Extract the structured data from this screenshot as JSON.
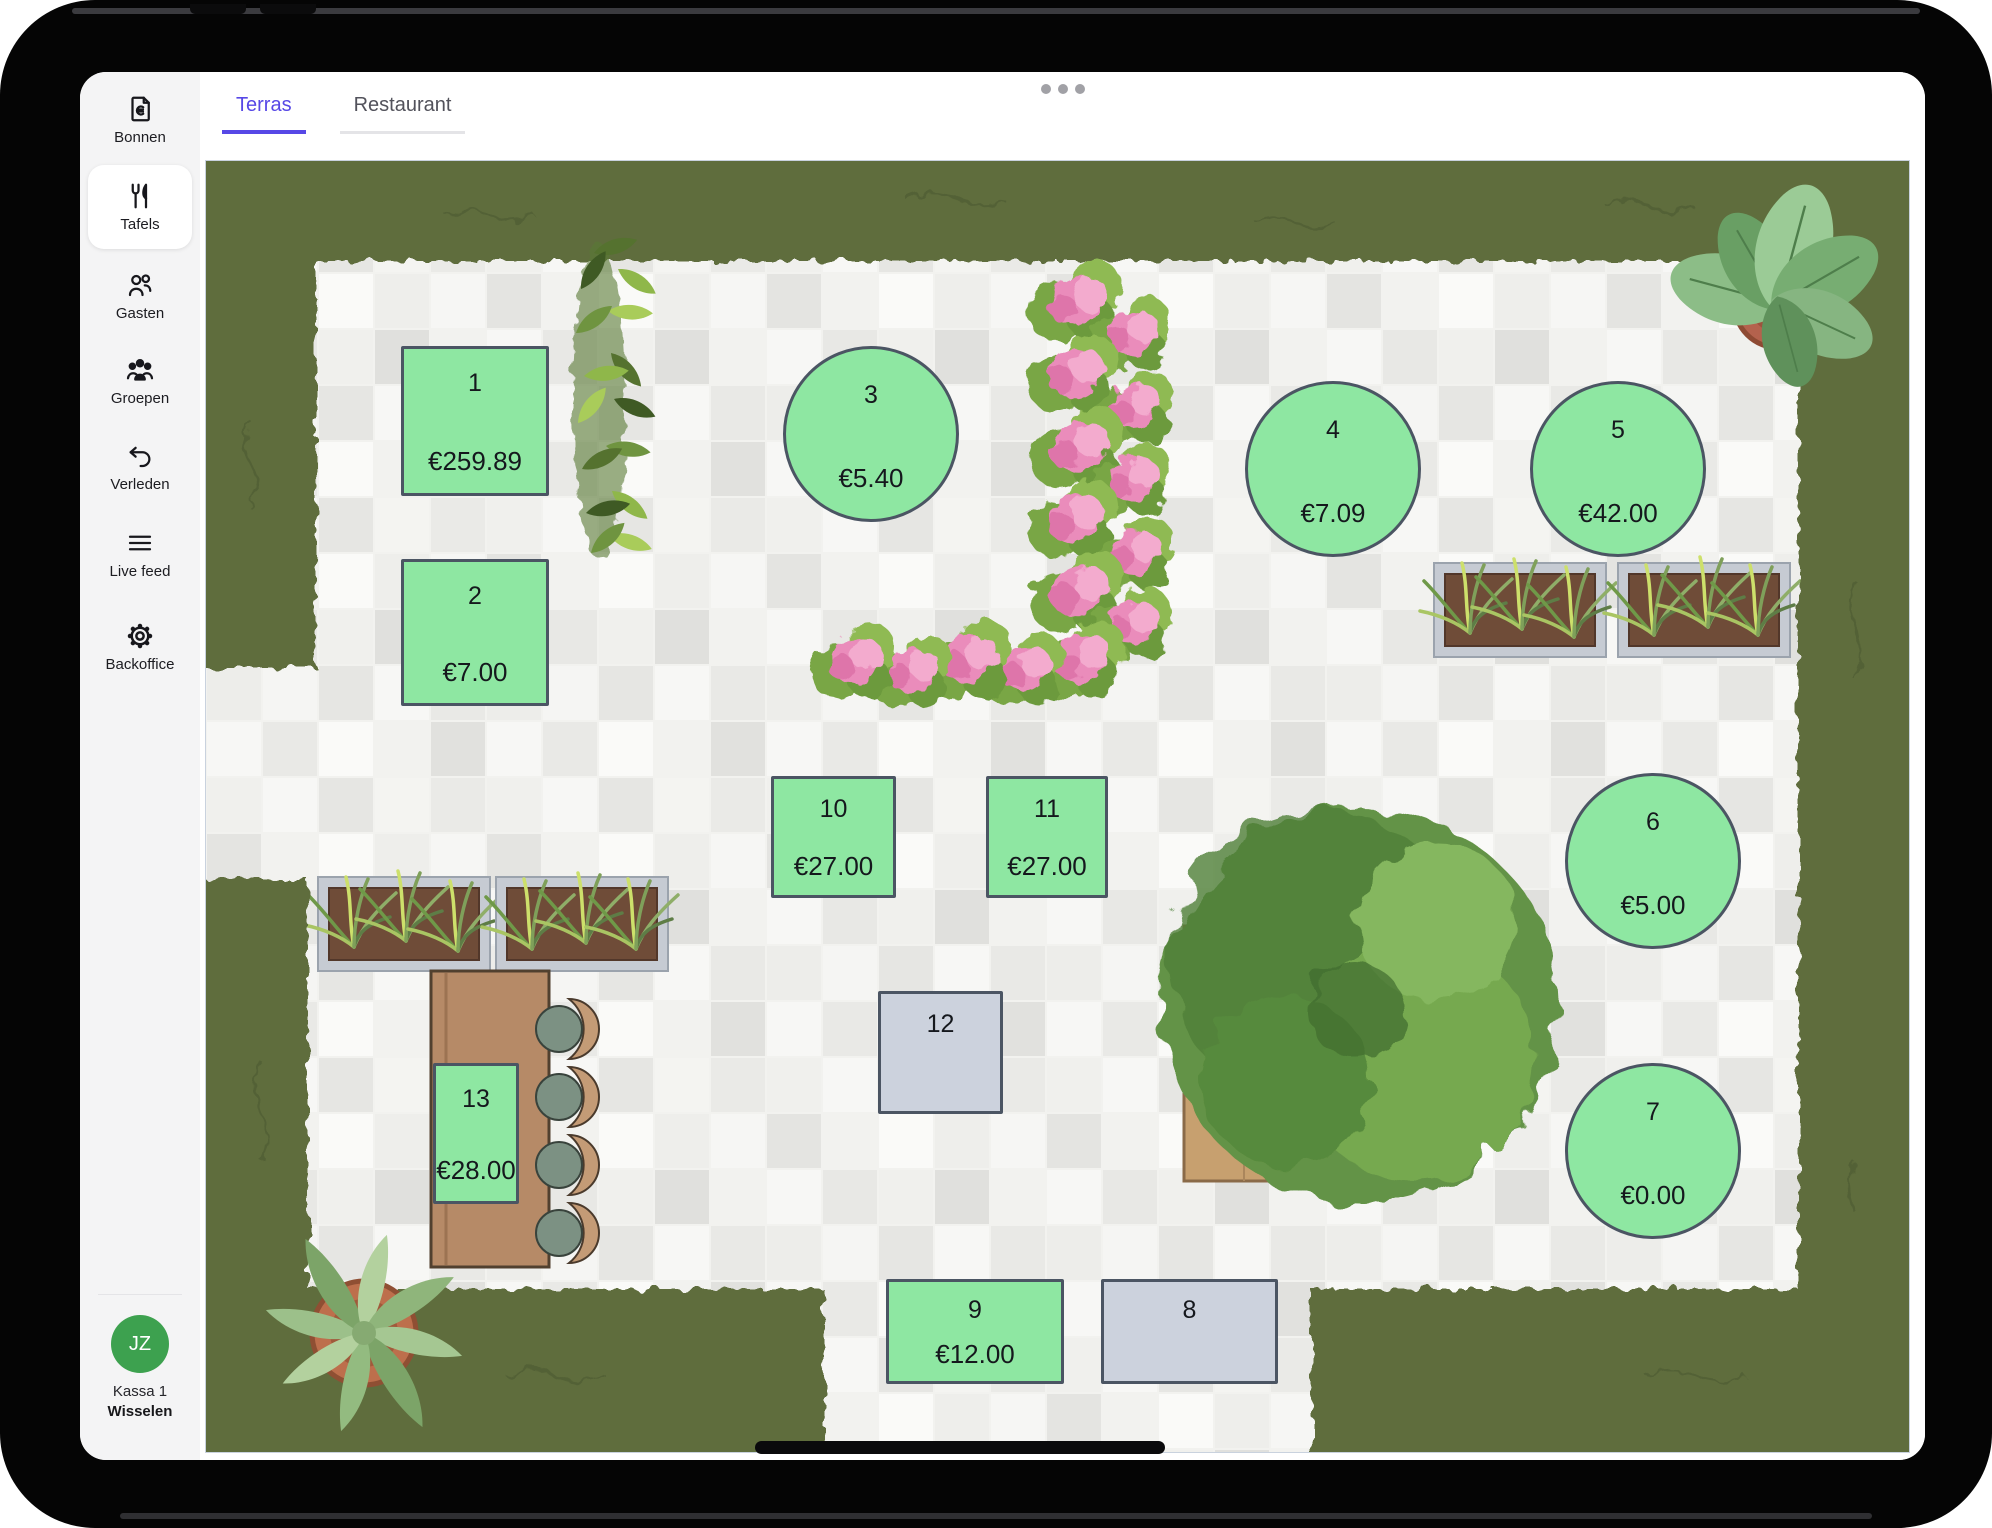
{
  "device": {
    "multitask_indicator_icon": "ellipsis-icon",
    "home_indicator_icon": "home-indicator-bar"
  },
  "colors": {
    "accent_purple": "#5748e6",
    "table_occupied_green": "#8ee7a2",
    "table_free_gray": "#ccd2dd",
    "table_border": "#4b5563",
    "avatar_green": "#3da14f",
    "fab_green": "#3ea14e",
    "hedge_green": "#5f6d3c",
    "sidebar_bg": "#f4f4f5"
  },
  "sidebar": {
    "items": [
      {
        "id": "bonnen",
        "label": "Bonnen",
        "icon": "receipt-euro-icon",
        "active": false
      },
      {
        "id": "tafels",
        "label": "Tafels",
        "icon": "utensils-icon",
        "active": true
      },
      {
        "id": "gasten",
        "label": "Gasten",
        "icon": "users-icon",
        "active": false
      },
      {
        "id": "groepen",
        "label": "Groepen",
        "icon": "users-group-icon",
        "active": false
      },
      {
        "id": "verleden",
        "label": "Verleden",
        "icon": "undo-icon",
        "active": false
      },
      {
        "id": "livefeed",
        "label": "Live feed",
        "icon": "menu-icon",
        "active": false
      },
      {
        "id": "backoffice",
        "label": "Backoffice",
        "icon": "gear-icon",
        "active": false
      }
    ],
    "user": {
      "initials": "JZ",
      "name": "Kassa 1",
      "action": "Wisselen"
    }
  },
  "tabs": [
    {
      "label": "Terras",
      "active": true
    },
    {
      "label": "Restaurant",
      "active": false
    }
  ],
  "floor_plan": {
    "tables": [
      {
        "number": "1",
        "amount": "€259.89",
        "shape": "rect",
        "status": "occupied",
        "x": 195,
        "y": 185,
        "w": 148,
        "h": 150
      },
      {
        "number": "2",
        "amount": "€7.00",
        "shape": "rect",
        "status": "occupied",
        "x": 195,
        "y": 398,
        "w": 148,
        "h": 147
      },
      {
        "number": "3",
        "amount": "€5.40",
        "shape": "circle",
        "status": "occupied",
        "x": 577,
        "y": 185,
        "w": 176,
        "h": 176
      },
      {
        "number": "4",
        "amount": "€7.09",
        "shape": "circle",
        "status": "occupied",
        "x": 1039,
        "y": 220,
        "w": 176,
        "h": 176
      },
      {
        "number": "5",
        "amount": "€42.00",
        "shape": "circle",
        "status": "occupied",
        "x": 1324,
        "y": 220,
        "w": 176,
        "h": 176
      },
      {
        "number": "6",
        "amount": "€5.00",
        "shape": "circle",
        "status": "occupied",
        "x": 1359,
        "y": 612,
        "w": 176,
        "h": 176
      },
      {
        "number": "7",
        "amount": "€0.00",
        "shape": "circle",
        "status": "occupied",
        "x": 1359,
        "y": 902,
        "w": 176,
        "h": 176
      },
      {
        "number": "10",
        "amount": "€27.00",
        "shape": "rect",
        "status": "occupied",
        "x": 565,
        "y": 615,
        "w": 125,
        "h": 122
      },
      {
        "number": "11",
        "amount": "€27.00",
        "shape": "rect",
        "status": "occupied",
        "x": 780,
        "y": 615,
        "w": 122,
        "h": 122
      },
      {
        "number": "12",
        "amount": "",
        "shape": "rect",
        "status": "free",
        "x": 672,
        "y": 830,
        "w": 125,
        "h": 123
      },
      {
        "number": "13",
        "amount": "€28.00",
        "shape": "rect",
        "status": "occupied",
        "x": 227,
        "y": 902,
        "w": 86,
        "h": 141
      },
      {
        "number": "9",
        "amount": "€12.00",
        "shape": "rect",
        "status": "occupied",
        "x": 680,
        "y": 1118,
        "w": 178,
        "h": 105
      },
      {
        "number": "8",
        "amount": "",
        "shape": "rect",
        "status": "free",
        "x": 895,
        "y": 1118,
        "w": 177,
        "h": 105
      }
    ]
  },
  "fab": {
    "icon": "menu-icon"
  }
}
